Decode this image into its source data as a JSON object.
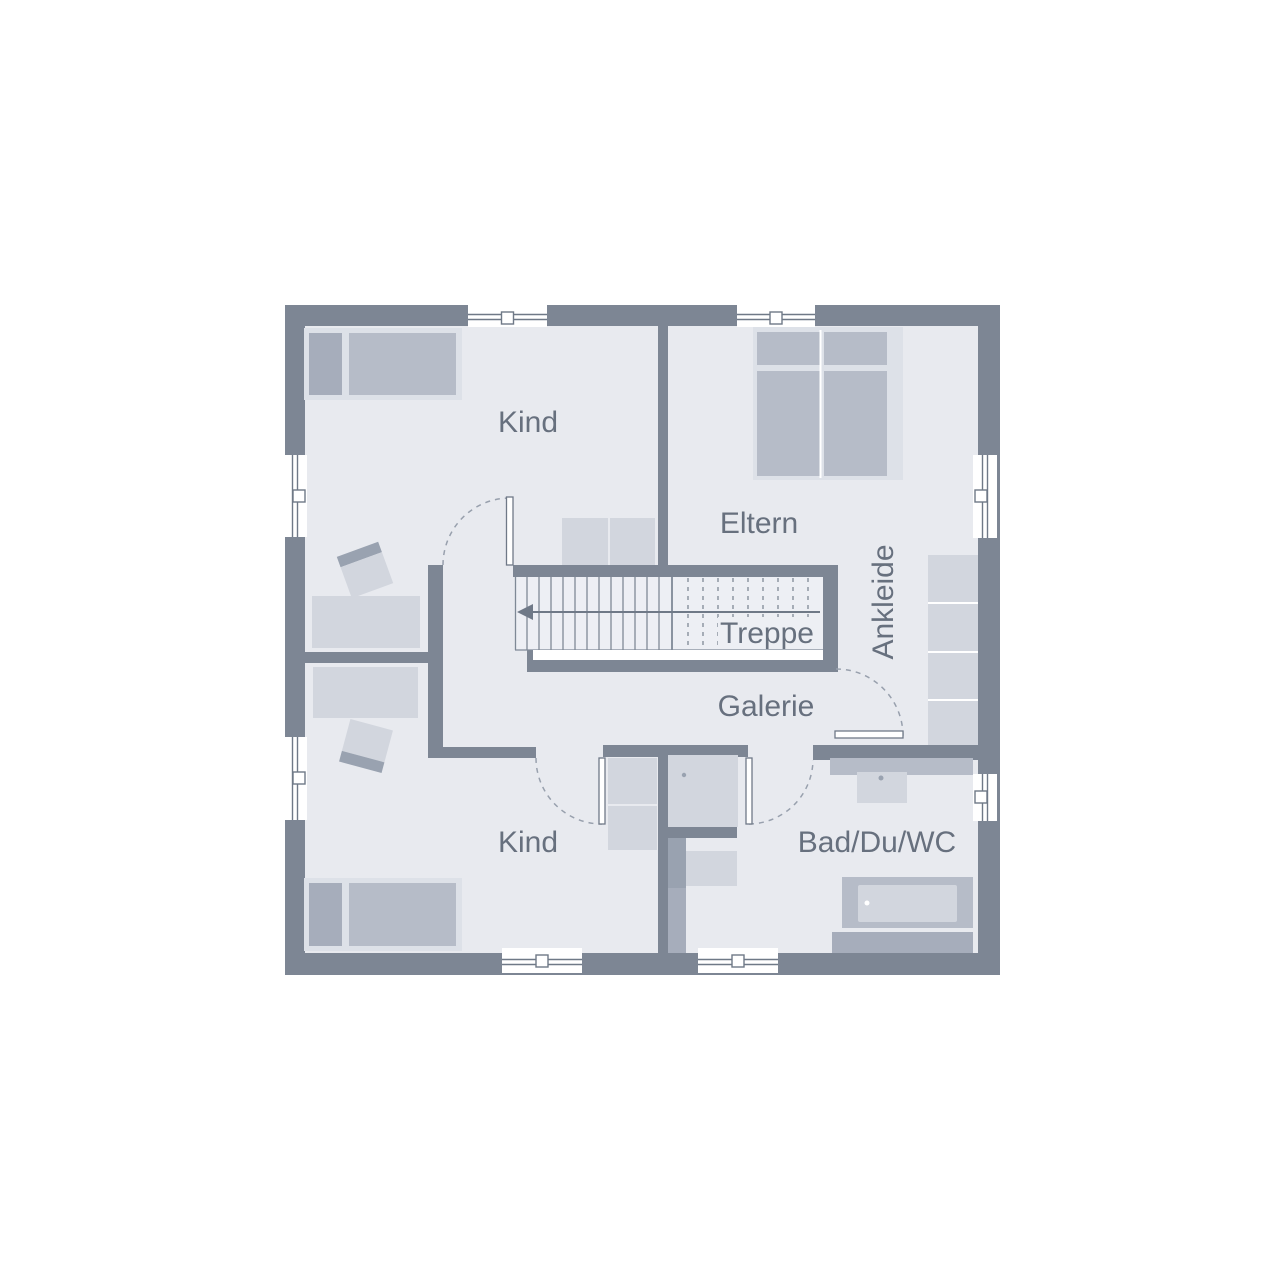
{
  "floorplan": {
    "title": "Obergeschoss Grundriss",
    "labels": {
      "kind_top": "Kind",
      "eltern": "Eltern",
      "ankleide": "Ankleide",
      "treppe": "Treppe",
      "galerie": "Galerie",
      "kind_bottom": "Kind",
      "bad": "Bad/Du/WC"
    },
    "colors": {
      "wall": "#7d8694",
      "floor": "#e8eaef",
      "stairfloor": "#edeff4",
      "frame": "#dde1e8",
      "light": "#d2d6de",
      "mid": "#b6bcc8",
      "dark": "#a6adbb",
      "darker": "#99a2b0",
      "line": "#6f7987",
      "tread": "#7f8996",
      "arc": "#98a0ad",
      "text": "#67707e"
    }
  }
}
